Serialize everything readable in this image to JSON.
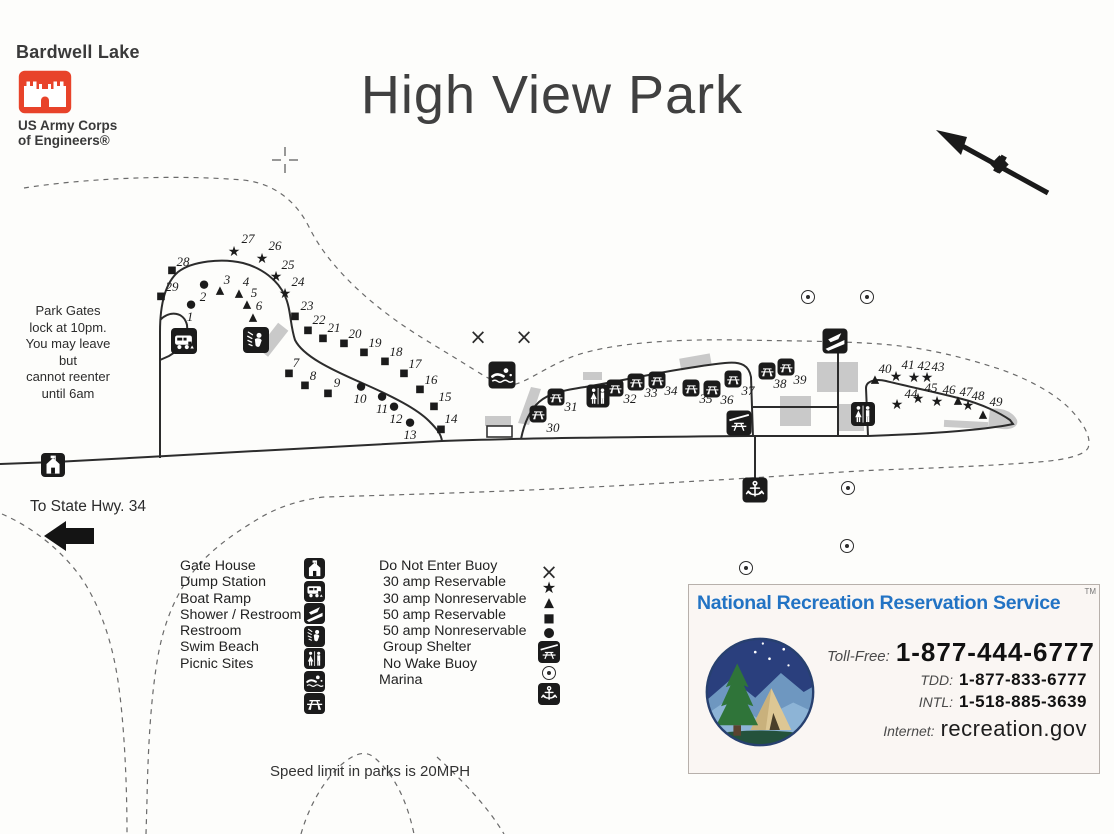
{
  "header": {
    "lake_name": "Bardwell Lake",
    "agency_line1": "US Army Corps",
    "agency_line2": "of Engineers®",
    "logo_color": "#e8432a"
  },
  "title": "High View Park",
  "notes": {
    "gate_lines": [
      "Park Gates",
      "lock at 10pm.",
      "You may leave",
      "but",
      "cannot reenter",
      "until 6am"
    ],
    "highway": "To State Hwy. 34",
    "speed": "Speed limit in parks is 20MPH"
  },
  "legend": {
    "facilities": [
      {
        "label": "Gate House",
        "icon": "gate-house"
      },
      {
        "label": "Dump Station",
        "icon": "dump-station"
      },
      {
        "label": "Boat Ramp",
        "icon": "boat-ramp"
      },
      {
        "label": "Shower / Restroom",
        "icon": "shower"
      },
      {
        "label": "Restroom",
        "icon": "restroom"
      },
      {
        "label": "Swim Beach",
        "icon": "swim-beach"
      },
      {
        "label": "Picnic Sites",
        "icon": "picnic"
      }
    ],
    "symbols": [
      {
        "label": "Do Not Enter Buoy",
        "symbol": "x"
      },
      {
        "label": " 30 amp Reservable",
        "symbol": "star"
      },
      {
        "label": " 30 amp Nonreservable",
        "symbol": "triangle"
      },
      {
        "label": " 50 amp Reservable",
        "symbol": "square"
      },
      {
        "label": " 50 amp Nonreservable",
        "symbol": "circle"
      },
      {
        "label": " Group Shelter",
        "symbol": "group-shelter"
      },
      {
        "label": " No Wake Buoy",
        "symbol": "no-wake"
      },
      {
        "label": "Marina",
        "symbol": "marina"
      }
    ]
  },
  "map": {
    "campsites": [
      {
        "n": 1,
        "t": "circle",
        "x": 191,
        "y": 304,
        "lx": 190,
        "ly": 317
      },
      {
        "n": 2,
        "t": "circle",
        "x": 204,
        "y": 284,
        "lx": 203,
        "ly": 297
      },
      {
        "n": 3,
        "t": "triangle",
        "x": 220,
        "y": 290,
        "lx": 227,
        "ly": 280
      },
      {
        "n": 4,
        "t": "triangle",
        "x": 239,
        "y": 293,
        "lx": 246,
        "ly": 282
      },
      {
        "n": 5,
        "t": "triangle",
        "x": 247,
        "y": 304,
        "lx": 254,
        "ly": 293
      },
      {
        "n": 6,
        "t": "triangle",
        "x": 253,
        "y": 317,
        "lx": 259,
        "ly": 306
      },
      {
        "n": 7,
        "t": "square",
        "x": 289,
        "y": 374,
        "lx": 296,
        "ly": 363
      },
      {
        "n": 8,
        "t": "square",
        "x": 305,
        "y": 386,
        "lx": 313,
        "ly": 376
      },
      {
        "n": 9,
        "t": "square",
        "x": 328,
        "y": 394,
        "lx": 337,
        "ly": 383
      },
      {
        "n": 10,
        "t": "circle",
        "x": 361,
        "y": 386,
        "lx": 360,
        "ly": 399
      },
      {
        "n": 11,
        "t": "circle",
        "x": 382,
        "y": 396,
        "lx": 382,
        "ly": 409
      },
      {
        "n": 12,
        "t": "circle",
        "x": 394,
        "y": 406,
        "lx": 396,
        "ly": 419
      },
      {
        "n": 13,
        "t": "circle",
        "x": 410,
        "y": 422,
        "lx": 410,
        "ly": 435
      },
      {
        "n": 14,
        "t": "square",
        "x": 441,
        "y": 430,
        "lx": 451,
        "ly": 419
      },
      {
        "n": 15,
        "t": "square",
        "x": 434,
        "y": 407,
        "lx": 445,
        "ly": 397
      },
      {
        "n": 16,
        "t": "square",
        "x": 420,
        "y": 390,
        "lx": 431,
        "ly": 380
      },
      {
        "n": 17,
        "t": "square",
        "x": 404,
        "y": 374,
        "lx": 415,
        "ly": 364
      },
      {
        "n": 18,
        "t": "square",
        "x": 385,
        "y": 362,
        "lx": 396,
        "ly": 352
      },
      {
        "n": 19,
        "t": "square",
        "x": 364,
        "y": 353,
        "lx": 375,
        "ly": 343
      },
      {
        "n": 20,
        "t": "square",
        "x": 344,
        "y": 344,
        "lx": 355,
        "ly": 334
      },
      {
        "n": 21,
        "t": "square",
        "x": 323,
        "y": 339,
        "lx": 334,
        "ly": 328
      },
      {
        "n": 22,
        "t": "square",
        "x": 308,
        "y": 331,
        "lx": 319,
        "ly": 320
      },
      {
        "n": 23,
        "t": "square",
        "x": 295,
        "y": 317,
        "lx": 307,
        "ly": 306
      },
      {
        "n": 24,
        "t": "star",
        "x": 285,
        "y": 294,
        "lx": 298,
        "ly": 282
      },
      {
        "n": 25,
        "t": "star",
        "x": 276,
        "y": 277,
        "lx": 288,
        "ly": 265
      },
      {
        "n": 26,
        "t": "star",
        "x": 262,
        "y": 259,
        "lx": 275,
        "ly": 246
      },
      {
        "n": 27,
        "t": "star",
        "x": 234,
        "y": 252,
        "lx": 248,
        "ly": 239
      },
      {
        "n": 28,
        "t": "square",
        "x": 172,
        "y": 271,
        "lx": 183,
        "ly": 262
      },
      {
        "n": 29,
        "t": "square",
        "x": 161,
        "y": 297,
        "lx": 172,
        "ly": 287
      },
      {
        "n": 30,
        "t": "picnic",
        "x": 538,
        "y": 414,
        "lx": 553,
        "ly": 428
      },
      {
        "n": 31,
        "t": "picnic",
        "x": 556,
        "y": 397,
        "lx": 571,
        "ly": 407
      },
      {
        "n": 32,
        "t": "picnic",
        "x": 615,
        "y": 388,
        "lx": 630,
        "ly": 399
      },
      {
        "n": 33,
        "t": "picnic",
        "x": 636,
        "y": 382,
        "lx": 651,
        "ly": 393
      },
      {
        "n": 34,
        "t": "picnic",
        "x": 657,
        "y": 380,
        "lx": 671,
        "ly": 391
      },
      {
        "n": 35,
        "t": "picnic",
        "x": 691,
        "y": 388,
        "lx": 706,
        "ly": 399
      },
      {
        "n": 36,
        "t": "picnic",
        "x": 712,
        "y": 389,
        "lx": 727,
        "ly": 400
      },
      {
        "n": 37,
        "t": "picnic",
        "x": 733,
        "y": 379,
        "lx": 748,
        "ly": 391
      },
      {
        "n": 38,
        "t": "picnic",
        "x": 767,
        "y": 371,
        "lx": 780,
        "ly": 384
      },
      {
        "n": 39,
        "t": "picnic",
        "x": 786,
        "y": 367,
        "lx": 800,
        "ly": 380
      },
      {
        "n": 40,
        "t": "triangle",
        "x": 875,
        "y": 379,
        "lx": 885,
        "ly": 369
      },
      {
        "n": 41,
        "t": "star",
        "x": 896,
        "y": 377,
        "lx": 908,
        "ly": 365
      },
      {
        "n": 42,
        "t": "star",
        "x": 914,
        "y": 378,
        "lx": 924,
        "ly": 366
      },
      {
        "n": 43,
        "t": "star",
        "x": 927,
        "y": 378,
        "lx": 938,
        "ly": 367
      },
      {
        "n": 44,
        "t": "star",
        "x": 897,
        "y": 405,
        "lx": 911,
        "ly": 394
      },
      {
        "n": 45,
        "t": "star",
        "x": 918,
        "y": 399,
        "lx": 931,
        "ly": 388
      },
      {
        "n": 46,
        "t": "star",
        "x": 937,
        "y": 402,
        "lx": 949,
        "ly": 390
      },
      {
        "n": 47,
        "t": "triangle",
        "x": 958,
        "y": 400,
        "lx": 966,
        "ly": 392
      },
      {
        "n": 48,
        "t": "star",
        "x": 968,
        "y": 406,
        "lx": 978,
        "ly": 396
      },
      {
        "n": 49,
        "t": "triangle",
        "x": 983,
        "y": 414,
        "lx": 996,
        "ly": 402
      }
    ],
    "facilities": [
      {
        "icon": "gate-house",
        "x": 53,
        "y": 465,
        "s": 24
      },
      {
        "icon": "dump-station",
        "x": 184,
        "y": 341,
        "s": 26
      },
      {
        "icon": "shower",
        "x": 256,
        "y": 340,
        "s": 26
      },
      {
        "icon": "swim-beach",
        "x": 502,
        "y": 375,
        "s": 27
      },
      {
        "icon": "restroom",
        "x": 598,
        "y": 396,
        "s": 23
      },
      {
        "icon": "boat-ramp",
        "x": 835,
        "y": 341,
        "s": 25
      },
      {
        "icon": "restroom",
        "x": 863,
        "y": 414,
        "s": 24
      },
      {
        "icon": "group-shelter",
        "x": 739,
        "y": 423,
        "s": 25
      },
      {
        "icon": "marina",
        "x": 755,
        "y": 490,
        "s": 25
      }
    ],
    "no_wake_buoys": [
      [
        808,
        297
      ],
      [
        867,
        297
      ],
      [
        848,
        488
      ],
      [
        847,
        546
      ],
      [
        746,
        568
      ]
    ],
    "do_not_enter_buoys": [
      [
        478,
        337
      ],
      [
        524,
        337
      ]
    ]
  },
  "nrrs": {
    "title": "National Recreation Reservation Service",
    "trademark": "TM",
    "title_color": "#2273c4",
    "contacts": [
      {
        "label": "Toll-Free:",
        "value": "1-877-444-6777"
      },
      {
        "label": "TDD:",
        "value": "1-877-833-6777"
      },
      {
        "label": "INTL:",
        "value": "1-518-885-3639"
      },
      {
        "label": "Internet:",
        "value": "recreation.gov"
      }
    ]
  }
}
